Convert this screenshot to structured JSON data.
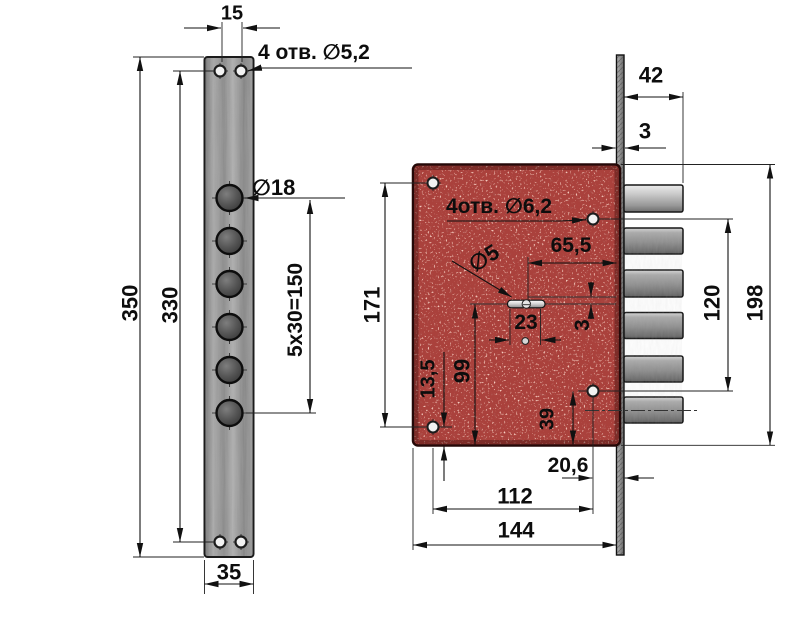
{
  "left_view": {
    "top_hole_spacing": "15",
    "holes_note": "4 отв. ∅5,2",
    "big_hole_dia": "∅18",
    "hole_pitch": "5x30=150",
    "overall_height": "350",
    "hole_span_height": "330",
    "plate_width": "35"
  },
  "right_view": {
    "bolt_throw": "42",
    "faceplate_thickness": "3",
    "holes_note": "4отв. ∅6,2",
    "cylinder_to_faceplate": "65,5",
    "pin_dia": "∅5",
    "slot_width": "23",
    "offset_small": "3",
    "hole_span_height": "171",
    "cylinder_height": "99",
    "hole_bottom_offset": "13,5",
    "hole_39": "39",
    "hole_edge_offset": "20,6",
    "hole_span_width": "112",
    "body_width": "144",
    "screw_span": "120",
    "body_height": "198"
  },
  "colors": {
    "body_red": "#aa413c",
    "metal_gray": "#9a9a9a",
    "line": "#111111"
  }
}
